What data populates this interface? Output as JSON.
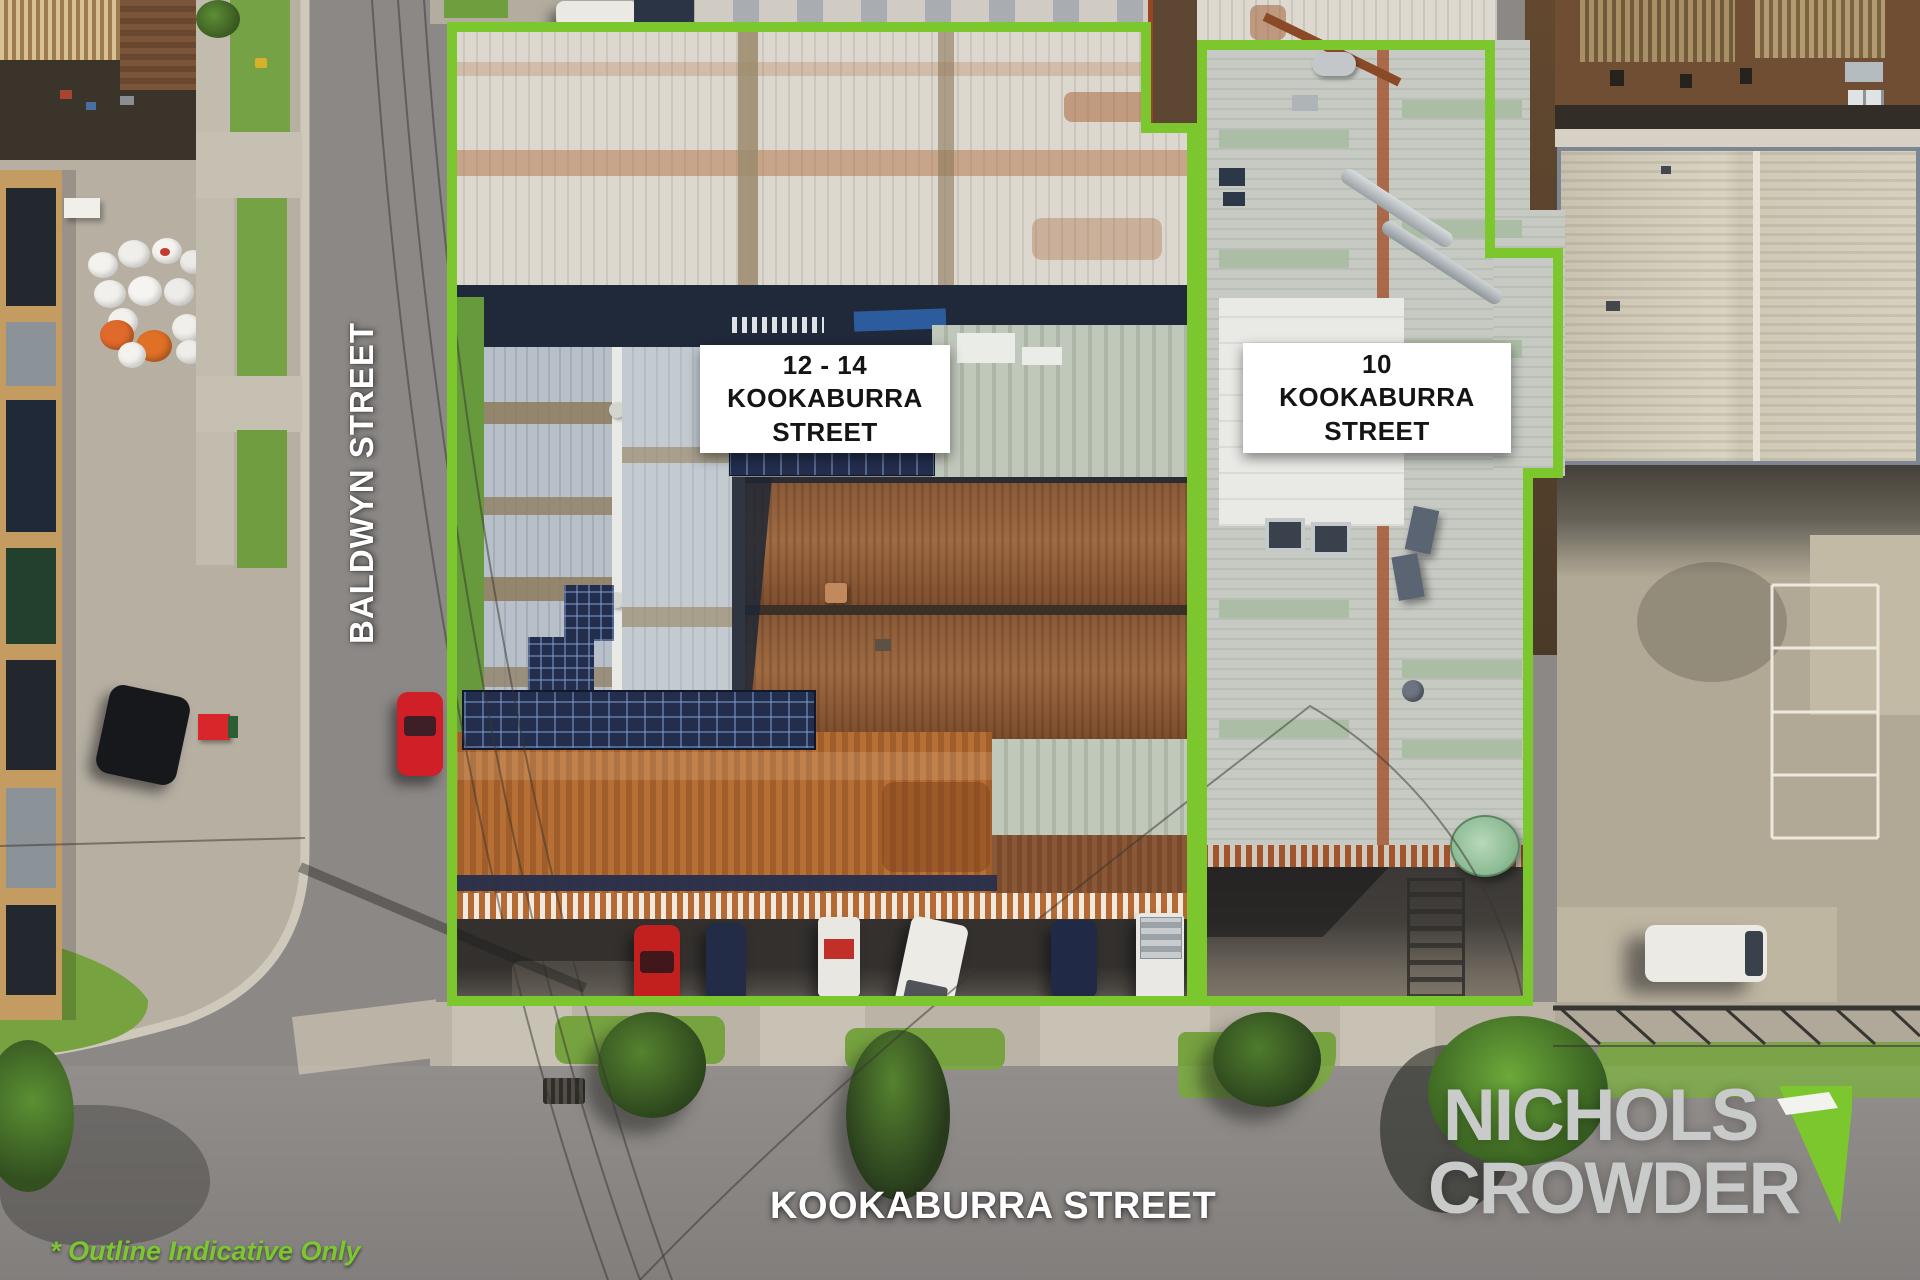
{
  "page": {
    "type": "aerial-property-marketing-photo"
  },
  "property_labels": {
    "p12_14": {
      "line1": "12 - 14",
      "line2": "KOOKABURRA",
      "line3": "STREET"
    },
    "p10": {
      "line1": "10",
      "line2": "KOOKABURRA",
      "line3": "STREET"
    }
  },
  "street_labels": {
    "baldwyn": "BALDWYN STREET",
    "kookaburra": "KOOKABURRA STREET"
  },
  "branding": {
    "name_line1": "NICHOLS",
    "name_line2": "CROWDER",
    "mark": "green-pennant-arrow"
  },
  "disclaimer": {
    "text": "* Outline Indicative Only"
  },
  "colors": {
    "outline_green": "#7CC62E",
    "disclaimer_green": "#7CC62F",
    "label_bg": "#FFFFFF",
    "label_text": "#141414",
    "street_text": "#FFFFFF",
    "logo_text": "#C9CBCA"
  }
}
